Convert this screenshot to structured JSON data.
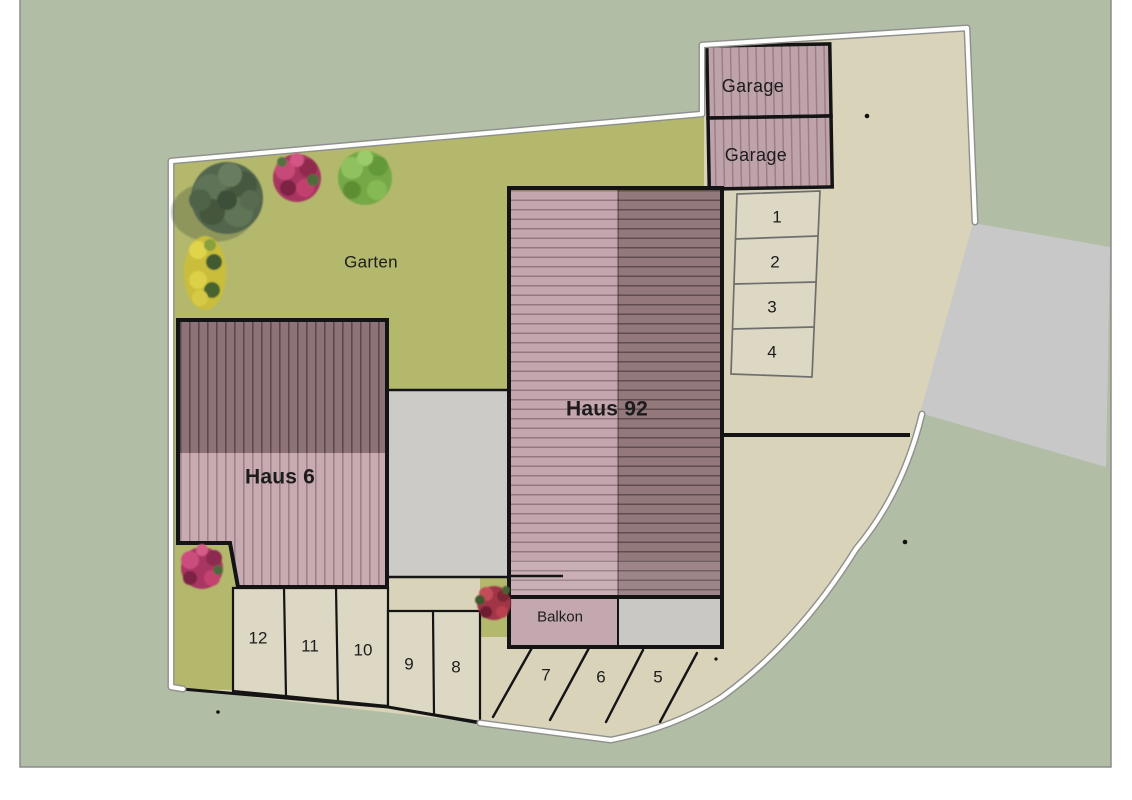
{
  "site_plan": {
    "garden_label": "Garten",
    "houses": [
      {
        "label": "Haus 6"
      },
      {
        "label": "Haus 92"
      }
    ],
    "garages": [
      {
        "label": "Garage"
      },
      {
        "label": "Garage"
      }
    ],
    "balcony_label": "Balkon",
    "parking_right_column": [
      "1",
      "2",
      "3",
      "4"
    ],
    "parking_bottom_row": [
      "12",
      "11",
      "10",
      "9",
      "8"
    ],
    "parking_diagonal_row": [
      "7",
      "6",
      "5"
    ],
    "colors": {
      "outer_margin": "#ffffff",
      "site_background": "#b2bda6",
      "garden_green": "#b4b86c",
      "paving_beige": "#d9d3ba",
      "stall_beige": "#ddd8c4",
      "road_gray": "#c8c8c8",
      "courtyard_gray": "#cccbc8",
      "roof_light_mauve": "#c4a7ae",
      "roof_dark_mauve": "#8d7377",
      "garage_mauve": "#bfa3ab",
      "boundary_white": "#fdfdfb",
      "outline_black": "#141414"
    }
  }
}
